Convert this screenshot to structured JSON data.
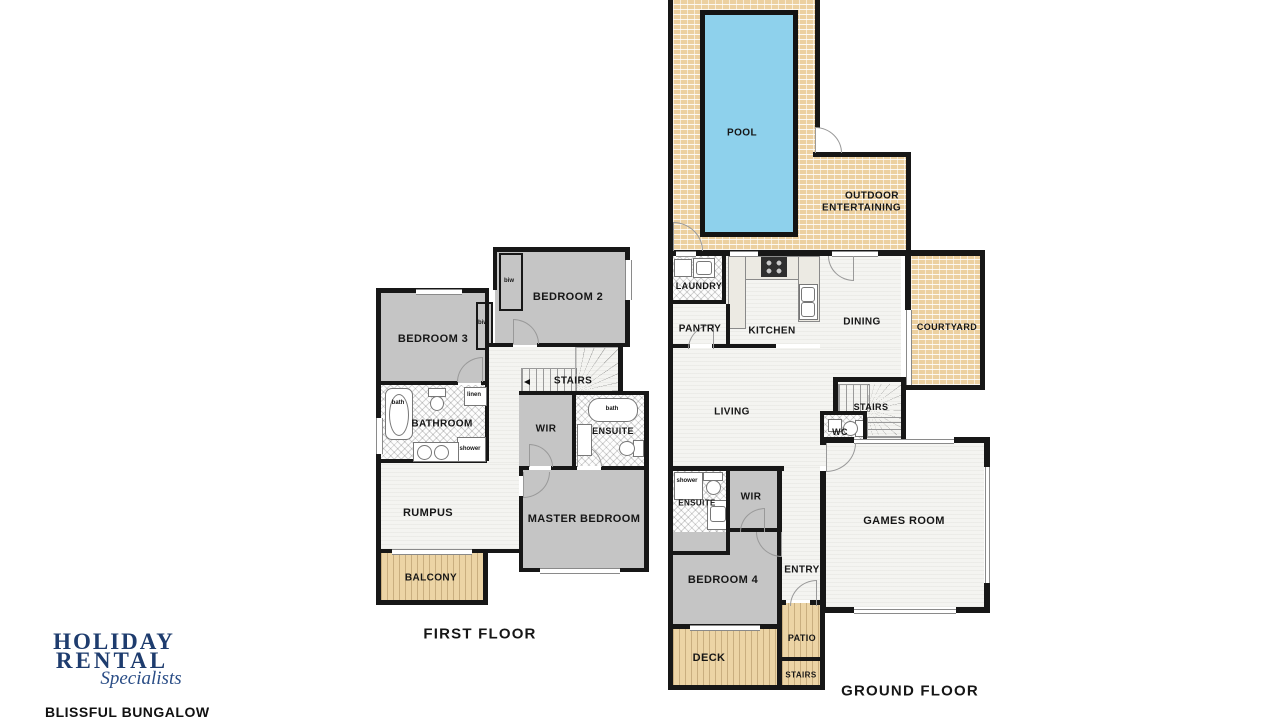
{
  "branding": {
    "logo_line1": "HOLIDAY",
    "logo_line2": "RENTAL",
    "logo_line3": "Specialists",
    "property_name": "BLISSFUL BUNGALOW",
    "logo_color": "#1e3c6e"
  },
  "first_floor": {
    "title": "FIRST FLOOR",
    "labels": {
      "bedroom2": "BEDROOM 2",
      "bedroom3": "BEDROOM 3",
      "biw_a": "biw",
      "biw_b": "biw",
      "stairs": "STAIRS",
      "bathroom": "BATHROOM",
      "bath": "bath",
      "linen": "linen",
      "shower": "shower",
      "wir": "WIR",
      "ensuite": "ENSUITE",
      "ensuite_bath": "bath",
      "rumpus": "RUMPUS",
      "master_bedroom": "MASTER BEDROOM",
      "balcony": "BALCONY"
    }
  },
  "ground_floor": {
    "title": "GROUND FLOOR",
    "labels": {
      "pool": "POOL",
      "outdoor_line1": "OUTDOOR",
      "outdoor_line2": "ENTERTAINING",
      "laundry": "LAUNDRY",
      "pantry": "PANTRY",
      "kitchen": "KITCHEN",
      "dining": "DINING",
      "courtyard": "COURTYARD",
      "living": "LIVING",
      "stairs_upper": "STAIRS",
      "wc": "WC",
      "games_room": "GAMES ROOM",
      "ensuite": "ENSUITE",
      "shower": "shower",
      "wir": "WIR",
      "bedroom4": "BEDROOM 4",
      "entry": "ENTRY",
      "patio": "PATIO",
      "deck": "DECK",
      "stairs_lower": "STAIRS"
    }
  },
  "colors": {
    "wall": "#171717",
    "brick_paving": "#ecd0a0",
    "timber_deck": "#ecd4a5",
    "carpet": "#c5c5c5",
    "pool_water": "#8ed1ec",
    "logo_navy": "#1e3c6e"
  }
}
